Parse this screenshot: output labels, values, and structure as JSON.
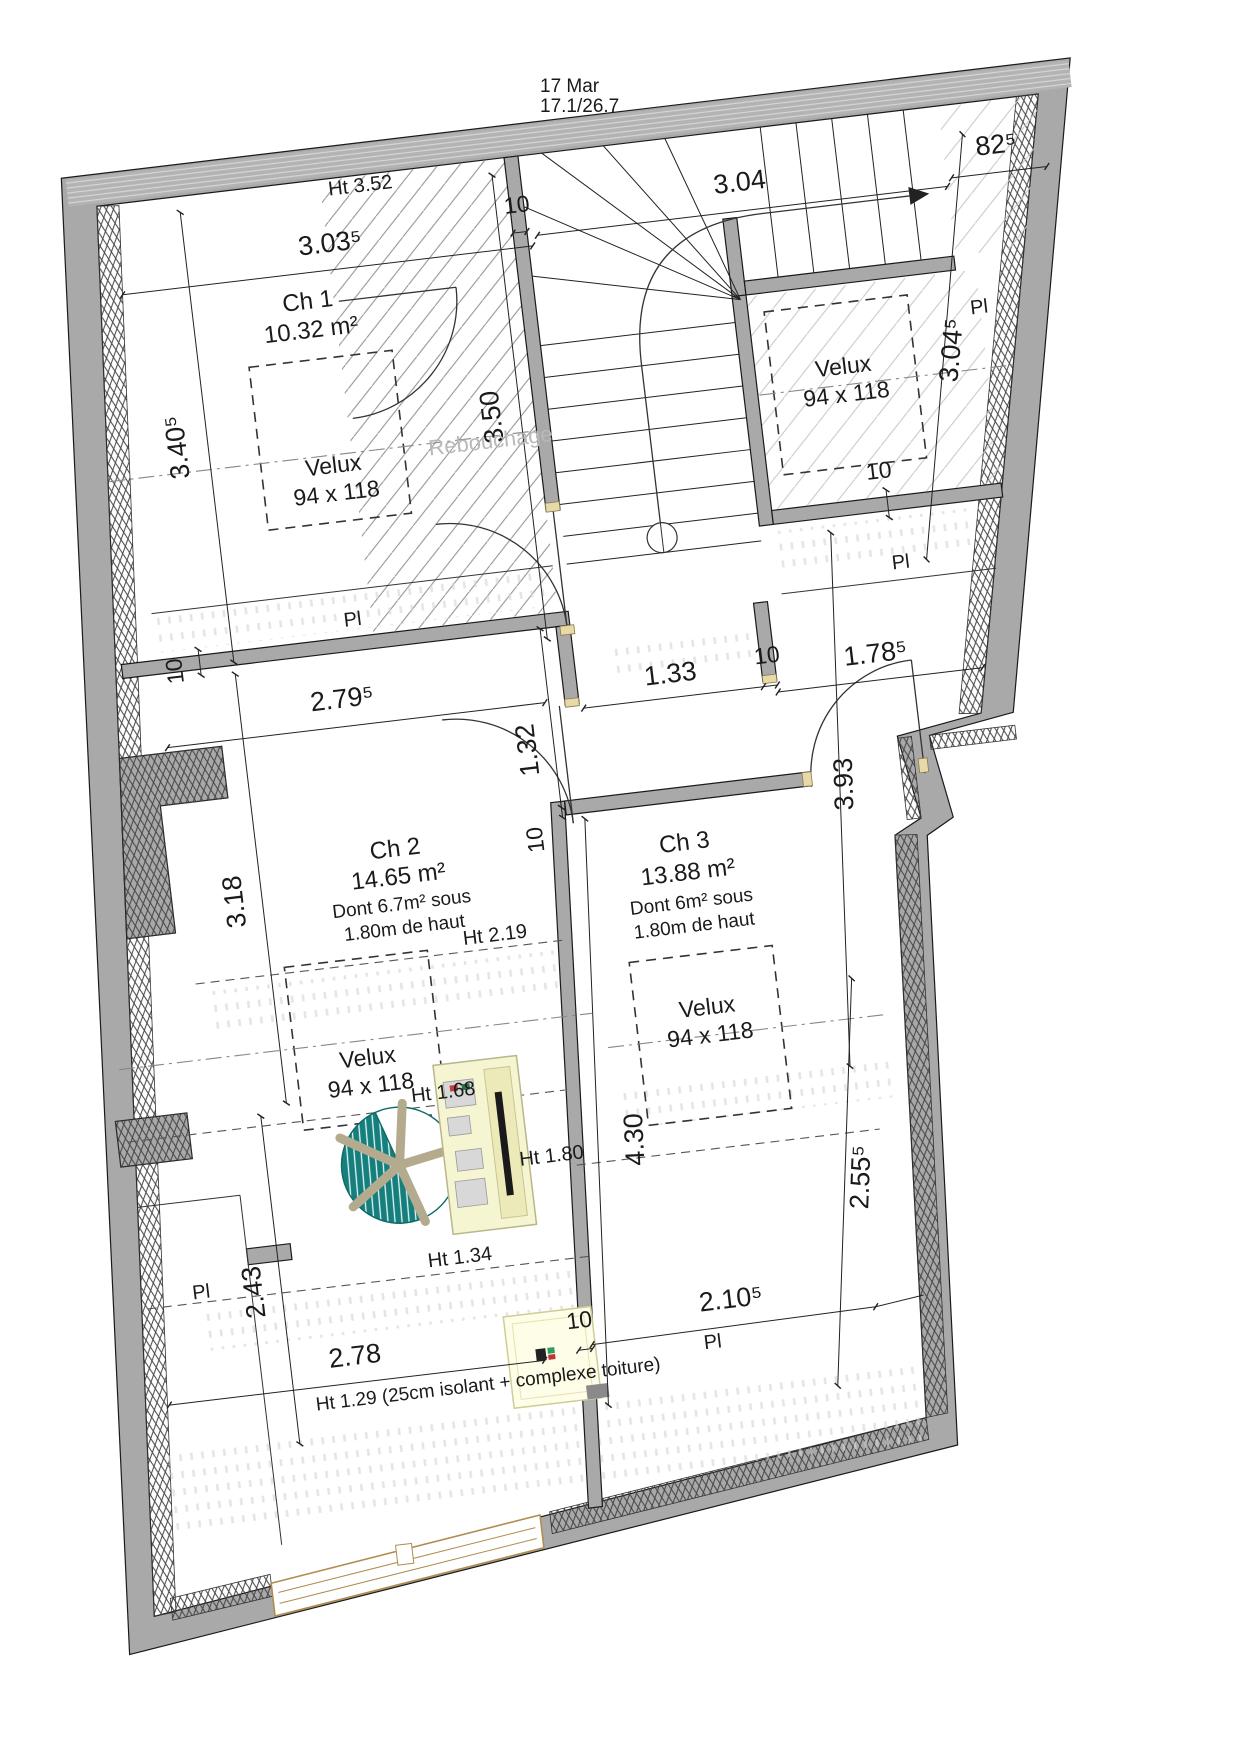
{
  "title": {
    "line1": "17 Mar",
    "line2": "17.1/26.7"
  },
  "rooms": {
    "ch1": {
      "name": "Ch 1",
      "area": "10.32 m²"
    },
    "ch2": {
      "name": "Ch 2",
      "area": "14.65 m²",
      "note1": "Dont  6.7m² sous",
      "note2": "1.80m de haut"
    },
    "ch3": {
      "name": "Ch 3",
      "area": "13.88 m²",
      "note1": "Dont  6m² sous",
      "note2": "1.80m de haut"
    }
  },
  "velux": {
    "label": "Velux",
    "size": "94 x 118"
  },
  "closet": {
    "label": "Pl"
  },
  "stair": {
    "note": "Rebouchage"
  },
  "heights": {
    "h352": "Ht 3.52",
    "h219": "Ht 2.19",
    "h180": "Ht 1.80",
    "h168": "Ht 1.68",
    "h134": "Ht 1.34",
    "h129": "Ht 1.29 (25cm isolant + complexe toiture)"
  },
  "dims": {
    "d3035": "3.03⁵",
    "d10": "10",
    "d304": "3.04",
    "d825": "82⁵",
    "d3045": "3.04⁵",
    "d3405": "3.40⁵",
    "d350": "3.50",
    "d2795": "2.79⁵",
    "d133": "1.33",
    "d132": "1.32",
    "d1785": "1.78⁵",
    "d393": "3.93",
    "d318": "3.18",
    "d243": "2.43",
    "d430": "4.30",
    "d2555": "2.55⁵",
    "d278": "2.78",
    "d2105": "2.10⁵"
  },
  "colors": {
    "wall_gray": "#a9a9a9",
    "chair_teal": "#157f7d",
    "desk_cream": "#f6f5d2",
    "window_tan": "#b08d4f"
  }
}
